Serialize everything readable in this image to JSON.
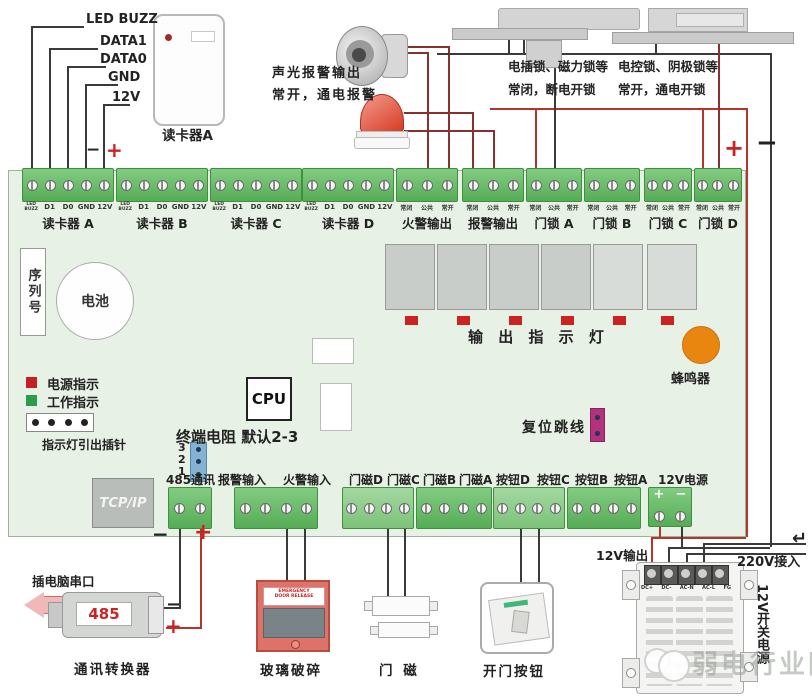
{
  "signs": {
    "plus": "+",
    "minus": "−",
    "return_arrow": "↵"
  },
  "colors": {
    "board_green": "#e8f1e5",
    "terminal_green": "#55ad55",
    "wire_red": "#b5342c",
    "wire_black": "#3a3a3a",
    "led_red": "#cc2222",
    "led_green": "#2c9c4a",
    "buzzer_orange": "#e8860f",
    "jumper_blue": "#85b2d3",
    "jumper_magenta": "#b5307d",
    "emergency_red": "#dd7268"
  },
  "top_left": {
    "wire_labels": [
      "LED BUZZ",
      "DATA1",
      "DATA0",
      "GND",
      "12V"
    ],
    "reader_caption": "读卡器A"
  },
  "alarm_note": {
    "line1": "声光报警输出",
    "line2": "常开，通电报警"
  },
  "lock_note1": {
    "line1": "电插锁、磁力锁等",
    "line2": "常闭，断电开锁"
  },
  "lock_note2": {
    "line1": "电控锁、阴极锁等",
    "line2": "常开，通电开锁"
  },
  "board": {
    "reader_pin_labels": [
      "LED\nBUZZ",
      "D1",
      "D0",
      "GND",
      "12V"
    ],
    "contact_pin_labels": [
      "常闭",
      "公共",
      "常开"
    ],
    "top_captions": [
      "读卡器 A",
      "读卡器 B",
      "读卡器 C",
      "读卡器 D",
      "火警输出",
      "报警输出",
      "门锁 A",
      "门锁 B",
      "门锁 C",
      "门锁 D"
    ],
    "serial_label": "序列号",
    "battery_label": "电池",
    "output_led_caption": "输 出 指 示 灯",
    "buzzer_label": "蜂鸣器",
    "power_indicator": "电源指示",
    "work_indicator": "工作指示",
    "pin_header_caption": "指示灯引出插针",
    "cpu_label": "CPU",
    "terminator_label": "终端电阻 默认2-3",
    "terminator_pins": [
      "3",
      "2",
      "1"
    ],
    "reset_jumper_label": "复位跳线",
    "tcpip_label": "TCP/IP",
    "bottom_labels": [
      "485通讯",
      "报警输入",
      "火警输入",
      "门磁D",
      "门磁C",
      "门磁B",
      "门磁A",
      "按钮D",
      "按钮C",
      "按钮B",
      "按钮A",
      "12V电源"
    ]
  },
  "bottom": {
    "serial_port_label": "插电脑串口",
    "converter_label": "485",
    "converter_caption": "通讯转换器",
    "glass_break": {
      "line1": "EMERGENCY",
      "line2": "DOOR RELEASE",
      "caption": "玻璃破碎"
    },
    "door_contact_caption": "门 磁",
    "exit_button_caption": "开门按钮",
    "psu": {
      "out_label": "12V输出",
      "in_label": "220V接入",
      "side_label": "12V开关电源",
      "terminals": [
        "DC+",
        "DC-",
        "AC-N",
        "AC-L",
        "FG"
      ]
    },
    "watermark": "弱电行业网"
  }
}
